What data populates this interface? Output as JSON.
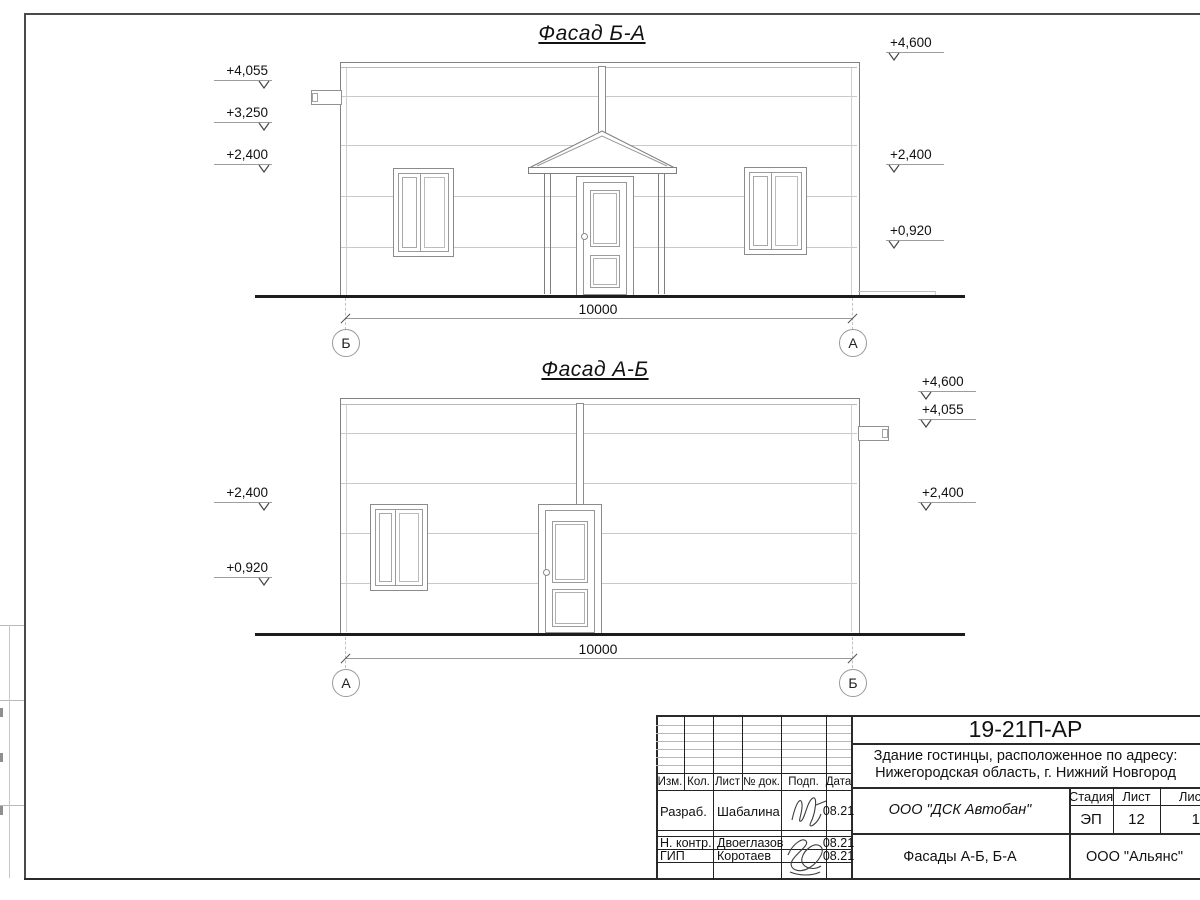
{
  "drawing": {
    "facades": {
      "top": {
        "title": "Фасад Б-А",
        "left_marks": [
          "+4,055",
          "+3,250",
          "+2,400"
        ],
        "right_marks": [
          "+4,600",
          "+2,400",
          "+0,920"
        ],
        "dimension": "10000",
        "axis_left": "Б",
        "axis_right": "А"
      },
      "bottom": {
        "title": "Фасад А-Б",
        "left_marks": [
          "+2,400",
          "+0,920"
        ],
        "right_marks": [
          "+4,600",
          "+4,055",
          "+2,400"
        ],
        "dimension": "10000",
        "axis_left": "А",
        "axis_right": "Б"
      }
    },
    "title_block": {
      "doc_number": "19-21П-АР",
      "project_address_line1": "Здание гостинцы, расположенное по адресу:",
      "project_address_line2": "Нижегородская область, г. Нижний Новгород",
      "columns": [
        "Изм.",
        "Кол.",
        "Лист",
        "№ док.",
        "Подп.",
        "Дата"
      ],
      "signature_rows": [
        {
          "role": "Разраб.",
          "name": "Шабалина",
          "date": "08.21"
        },
        {
          "role": "Н. контр.",
          "name": "Двоеглазов",
          "date": "08.21"
        },
        {
          "role": "ГИП",
          "name": "Коротаев",
          "date": "08.21"
        }
      ],
      "design_company": "ООО \"ДСК Автобан\"",
      "stage_label": "Стадия",
      "sheet_label": "Лист",
      "sheets_label": "Листов",
      "stage": "ЭП",
      "sheet_number": "12",
      "sheets_total": "18",
      "sheet_title": "Фасады А-Б, Б-А",
      "client_company": "ООО \"Альянс\""
    }
  }
}
